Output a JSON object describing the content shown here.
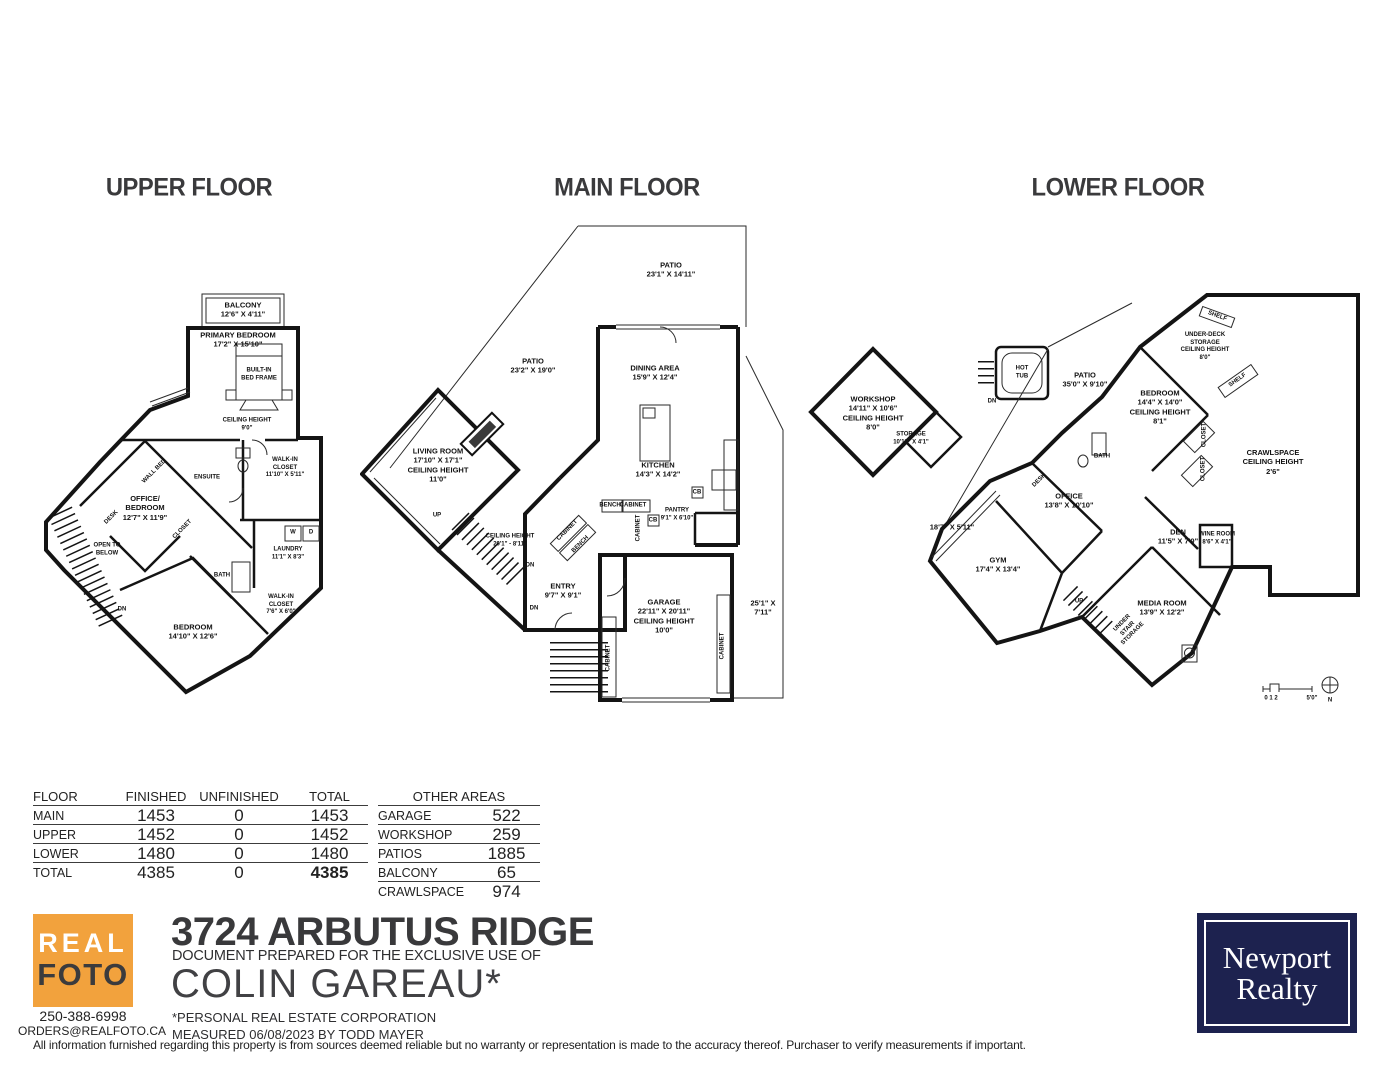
{
  "floors": {
    "upper": {
      "title": "UPPER FLOOR",
      "labels": [
        "BALCONY\n12'6\" X 4'11\"",
        "PRIMARY BEDROOM\n17'2\" X 15'10\"",
        "BUILT-IN\nBED FRAME",
        "CEILING HEIGHT\n9'0\"",
        "ENSUITE",
        "WALK-IN\nCLOSET\n11'10\" X 5'11\"",
        "OFFICE/\nBEDROOM\n12'7\" X 11'9\"",
        "WALL BED",
        "DESK",
        "OPEN TO\nBELOW",
        "CLOSET",
        "LAUNDRY\n11'1\" X 8'3\"",
        "W",
        "D",
        "BATH",
        "WALK-IN\nCLOSET\n7'6\" X 6'0\"",
        "BEDROOM\n14'10\" X 12'6\"",
        "DN"
      ]
    },
    "main": {
      "title": "MAIN FLOOR",
      "labels": [
        "PATIO\n23'1\" X 14'11\"",
        "PATIO\n23'2\" X 19'0\"",
        "DINING AREA\n15'9\" X 12'4\"",
        "LIVING ROOM\n17'10\" X 17'1\"\nCEILING HEIGHT\n11'0\"",
        "KITCHEN\n14'3\" X 14'2\"",
        "BENCH",
        "CABINET",
        "CB",
        "CB",
        "PANTRY\n9'1\" X 6'10\"",
        "CABINET",
        "CEILING HEIGHT\n20'1\" - 8'11\"",
        "UP",
        "DN",
        "DN",
        "ENTRY\n9'7\" X 9'1\"",
        "CABINET",
        "BENCH",
        "GARAGE\n22'11\" X 20'11\"\nCEILING HEIGHT\n10'0\"",
        "CABINET",
        "CABINET",
        "25'1\" X 7'11\""
      ]
    },
    "lower": {
      "title": "LOWER FLOOR",
      "labels": [
        "WORKSHOP\n14'11\" X 10'6\"\nCEILING HEIGHT\n8'0\"",
        "STORAGE\n10'11\" X 4'1\"",
        "HOT\nTUB",
        "DN",
        "PATIO\n35'0\" X 9'10\"",
        "SHELF",
        "UNDER-DECK\nSTORAGE\nCEILING HEIGHT\n8'0\"",
        "SHELF",
        "BEDROOM\n14'4\" X 14'0\"\nCEILING HEIGHT\n8'1\"",
        "CLOSET",
        "CLOSET",
        "CRAWLSPACE\nCEILING HEIGHT\n2'6\"",
        "BATH",
        "DESK",
        "OFFICE\n13'8\" X 10'10\"",
        "18'7\" X 5'11\"",
        "GYM\n17'4\" X 13'4\"",
        "DEN\n11'5\" X 7'9\"",
        "WINE ROOM\n8'6\" X 4'1\"",
        "MEDIA ROOM\n13'9\" X 12'2\"",
        "UP",
        "UNDER\nSTAIR\nSTORAGE",
        "0  1  2",
        "5'0\"",
        "N"
      ]
    }
  },
  "tables": {
    "floor": {
      "headers": [
        "FLOOR",
        "FINISHED",
        "UNFINISHED",
        "TOTAL"
      ],
      "rows": [
        {
          "floor": "MAIN",
          "finished": "1453",
          "unfinished": "0",
          "total": "1453"
        },
        {
          "floor": "UPPER",
          "finished": "1452",
          "unfinished": "0",
          "total": "1452"
        },
        {
          "floor": "LOWER",
          "finished": "1480",
          "unfinished": "0",
          "total": "1480"
        },
        {
          "floor": "TOTAL",
          "finished": "4385",
          "unfinished": "0",
          "total": "4385"
        }
      ]
    },
    "other": {
      "header": "OTHER AREAS",
      "rows": [
        {
          "label": "GARAGE",
          "value": "522"
        },
        {
          "label": "WORKSHOP",
          "value": "259"
        },
        {
          "label": "PATIOS",
          "value": "1885"
        },
        {
          "label": "BALCONY",
          "value": "65"
        },
        {
          "label": "CRAWLSPACE",
          "value": "974"
        }
      ]
    }
  },
  "branding": {
    "realfoto": {
      "line1": "REAL",
      "line2": "FOTO",
      "phone": "250-388-6998",
      "email": "ORDERS@REALFOTO.CA",
      "orange": "#f2a23d"
    },
    "address": "3724 ARBUTUS RIDGE",
    "prepared_for": "DOCUMENT PREPARED FOR THE EXCLUSIVE USE OF",
    "client": "COLIN GAREAU*",
    "client_note": "*PERSONAL REAL ESTATE CORPORATION",
    "measured": "MEASURED 06/08/2023   BY TODD MAYER",
    "newport": {
      "line1": "Newport",
      "line2": "Realty",
      "navy": "#1d224f"
    }
  },
  "disclaimer": "All information furnished regarding this property is from sources deemed reliable but no warranty or representation is made to the accuracy thereof. Purchaser to verify measurements if important."
}
